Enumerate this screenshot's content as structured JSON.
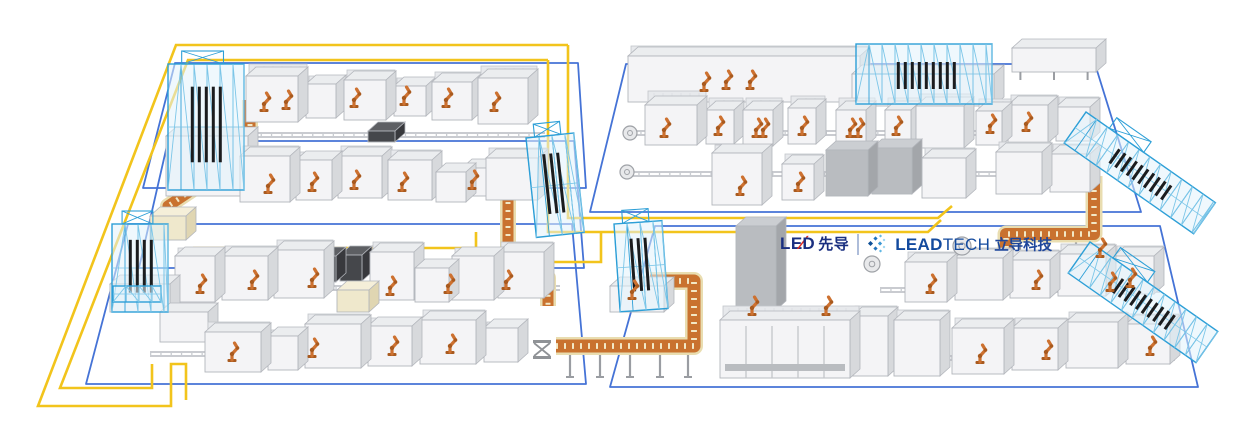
{
  "canvas": {
    "w": 1235,
    "h": 441,
    "bg": "#ffffff"
  },
  "logo": {
    "lead_prefix": "LE",
    "lead_slash": "∕",
    "lead_suffix": "D",
    "lead_cn": "先导",
    "brand_bold": "LEAD",
    "brand_light": "TECH",
    "brand_cn": "立导科技",
    "colors": {
      "navy": "#1a2f80",
      "red": "#e02b20",
      "brand_blue": "#134a9e",
      "separator": "#aebdda"
    },
    "icon_colors": [
      "#0d4f97",
      "#2173bc",
      "#3b97d3",
      "#62b8e4",
      "#8ed0ef"
    ],
    "icon_diamonds": [
      {
        "x": 3.5,
        "y": 9.5,
        "s": 3.6,
        "c": 0
      },
      {
        "x": 8.5,
        "y": 4.5,
        "s": 3.0,
        "c": 1
      },
      {
        "x": 8.5,
        "y": 14.5,
        "s": 3.0,
        "c": 1
      },
      {
        "x": 13.0,
        "y": 9.5,
        "s": 3.0,
        "c": 2
      },
      {
        "x": 13.5,
        "y": 2.0,
        "s": 2.2,
        "c": 3
      },
      {
        "x": 13.5,
        "y": 17.0,
        "s": 2.2,
        "c": 3
      },
      {
        "x": 17.0,
        "y": 6.0,
        "s": 1.9,
        "c": 4
      },
      {
        "x": 17.0,
        "y": 13.0,
        "s": 1.9,
        "c": 4
      }
    ]
  },
  "palette": {
    "zone_blue": "#4573d6",
    "agv_yellow": "#f2c41c",
    "rail": "#b7bac0",
    "rail_tick": "#c9ccd1",
    "conv_tan": "#e9ddb0",
    "conv_orange": "#c9722f",
    "conv_rung": "#f2e8c6",
    "machine_front": "#f4f4f6",
    "machine_top": "#ebedef",
    "machine_side": "#d7d9dc",
    "machine_stroke": "#b3b6bc",
    "backwall": "#e7e9ec",
    "backwall_stroke": "#c2c5ca",
    "dark_front": "#45474b",
    "dark_top": "#5d5f63",
    "dark_side": "#38393d",
    "med_front": "#b9bcc0",
    "med_top": "#cbced2",
    "med_side": "#a3a6aa",
    "blue_equip": "#cfe2f2",
    "tan_front": "#efe8cc",
    "tan_top": "#f5efd9",
    "tan_side": "#e0d6b2",
    "truss_blue": "#2d9fd7",
    "truss_light": "#7cc6e8",
    "truss_fill": "rgba(226,243,252,0.55)",
    "slat": "#1b1c1e",
    "robot": "#cd7130",
    "robot_dark": "#a85a1f",
    "lift_gray": "#8f9296"
  },
  "floor_zones": [
    {
      "name": "left-top",
      "points": "175,63 578,63 586,188 143,188"
    },
    {
      "name": "left-middle",
      "points": "168,141 574,141 584,268 139,268"
    },
    {
      "name": "left-bottom",
      "points": "128,224 572,224 586,384 86,384"
    },
    {
      "name": "right-top",
      "points": "626,64 1095,64 1141,212 590,212"
    },
    {
      "name": "right-bottom",
      "points": "655,226 1160,226 1198,387 610,387"
    }
  ],
  "agv_paths": [
    {
      "name": "outer-loop",
      "d": "M568,45 H176 L38,406 H171 V364 H186 V400"
    },
    {
      "name": "inner-loop",
      "d": "M548,60 H188 L60,388 H152 V364"
    },
    {
      "name": "cross-outer",
      "d": "M568,45 V218 H938 L952,206"
    },
    {
      "name": "cross-inner",
      "d": "M548,60 V232 H928 L941,220"
    },
    {
      "name": "branch-a",
      "d": "M476,232 V248 H193"
    },
    {
      "name": "branch-b",
      "d": "M601,232 V262 H193"
    }
  ],
  "rails": [
    {
      "y": 133,
      "x1": 240,
      "x2": 545
    },
    {
      "y": 189,
      "x1": 230,
      "x2": 545
    },
    {
      "y": 286,
      "x1": 150,
      "x2": 560
    },
    {
      "y": 352,
      "x1": 150,
      "x2": 520
    },
    {
      "y": 131,
      "x1": 630,
      "x2": 1090
    },
    {
      "y": 172,
      "x1": 628,
      "x2": 1085
    },
    {
      "y": 288,
      "x1": 880,
      "x2": 1160
    },
    {
      "y": 356,
      "x1": 910,
      "x2": 1175
    }
  ],
  "conveyors": [
    {
      "name": "spiral-left",
      "d": "M250,100 V130 L210,160 V178 L168,206 V234",
      "w": 11
    },
    {
      "name": "center-stair",
      "d": "M486,170 L508,196 V246 L548,278 V306",
      "w": 11
    },
    {
      "name": "bottom-bridge",
      "d": "M556,346 H694 V281 H650",
      "w": 13
    },
    {
      "name": "right-bridge",
      "d": "M1006,264 V234 H1094 V176",
      "w": 12
    }
  ],
  "bridge_legs": [
    [
      570,
      353,
      377
    ],
    [
      600,
      353,
      377
    ],
    [
      630,
      353,
      377
    ],
    [
      660,
      353,
      377
    ],
    [
      688,
      353,
      377
    ],
    [
      1020,
      240,
      262
    ],
    [
      1048,
      238,
      260
    ],
    [
      1076,
      236,
      258
    ]
  ],
  "machines": [
    [
      166,
      196,
      82,
      60,
      0,
      0
    ],
    [
      246,
      122,
      52,
      46,
      12,
      0
    ],
    [
      306,
      118,
      30,
      34,
      8,
      0
    ],
    [
      344,
      120,
      42,
      40,
      10,
      0
    ],
    [
      394,
      116,
      32,
      30,
      8,
      0
    ],
    [
      432,
      120,
      40,
      38,
      10,
      0
    ],
    [
      478,
      124,
      50,
      46,
      12,
      0
    ],
    [
      368,
      142,
      27,
      11,
      0,
      1
    ],
    [
      150,
      240,
      36,
      24,
      0,
      5
    ],
    [
      240,
      202,
      50,
      46,
      10,
      0
    ],
    [
      296,
      200,
      36,
      40,
      8,
      0
    ],
    [
      338,
      198,
      44,
      42,
      10,
      0
    ],
    [
      388,
      200,
      44,
      40,
      10,
      0
    ],
    [
      436,
      202,
      30,
      30,
      0,
      0
    ],
    [
      462,
      196,
      26,
      28,
      0,
      0
    ],
    [
      486,
      200,
      52,
      42,
      10,
      0
    ],
    [
      314,
      282,
      22,
      26,
      0,
      1
    ],
    [
      340,
      281,
      22,
      26,
      0,
      1
    ],
    [
      110,
      312,
      60,
      28,
      0,
      0
    ],
    [
      175,
      302,
      40,
      46,
      8,
      0
    ],
    [
      222,
      300,
      46,
      44,
      10,
      0
    ],
    [
      274,
      298,
      50,
      48,
      10,
      0
    ],
    [
      337,
      312,
      32,
      22,
      0,
      5
    ],
    [
      370,
      300,
      44,
      48,
      10,
      0
    ],
    [
      415,
      302,
      34,
      34,
      0,
      0
    ],
    [
      452,
      300,
      42,
      44,
      8,
      0
    ],
    [
      498,
      298,
      46,
      46,
      10,
      0
    ],
    [
      160,
      342,
      48,
      30,
      6,
      0
    ],
    [
      205,
      372,
      56,
      40,
      10,
      0
    ],
    [
      268,
      370,
      30,
      34,
      6,
      0
    ],
    [
      305,
      368,
      56,
      44,
      10,
      0
    ],
    [
      368,
      366,
      44,
      40,
      8,
      0
    ],
    [
      420,
      364,
      56,
      44,
      10,
      0
    ],
    [
      484,
      362,
      34,
      34,
      6,
      0
    ],
    [
      628,
      102,
      232,
      46,
      10,
      0
    ],
    [
      644,
      96,
      18,
      20,
      0,
      6
    ],
    [
      666,
      94,
      16,
      18,
      0,
      6
    ],
    [
      852,
      106,
      142,
      32,
      0,
      0
    ],
    [
      1012,
      72,
      84,
      24,
      0,
      4
    ],
    [
      645,
      145,
      52,
      40,
      14,
      0
    ],
    [
      706,
      144,
      28,
      34,
      12,
      0
    ],
    [
      743,
      146,
      30,
      36,
      12,
      0
    ],
    [
      788,
      144,
      28,
      36,
      12,
      0
    ],
    [
      836,
      146,
      30,
      36,
      12,
      0
    ],
    [
      885,
      144,
      26,
      34,
      12,
      0
    ],
    [
      916,
      148,
      48,
      42,
      12,
      0
    ],
    [
      976,
      145,
      26,
      34,
      12,
      0
    ],
    [
      1008,
      143,
      40,
      38,
      10,
      0
    ],
    [
      1056,
      141,
      34,
      34,
      10,
      0
    ],
    [
      712,
      205,
      50,
      52,
      8,
      0
    ],
    [
      782,
      200,
      32,
      36,
      10,
      0
    ],
    [
      826,
      196,
      42,
      46,
      0,
      3
    ],
    [
      872,
      194,
      40,
      46,
      0,
      3
    ],
    [
      922,
      198,
      44,
      40,
      10,
      0
    ],
    [
      996,
      194,
      46,
      42,
      10,
      0
    ],
    [
      1050,
      192,
      40,
      38,
      10,
      0
    ],
    [
      610,
      312,
      54,
      26,
      0,
      0
    ],
    [
      736,
      310,
      40,
      84,
      0,
      3
    ],
    [
      905,
      302,
      42,
      40,
      10,
      0
    ],
    [
      955,
      300,
      48,
      42,
      10,
      0
    ],
    [
      1010,
      298,
      40,
      38,
      10,
      0
    ],
    [
      1058,
      296,
      48,
      42,
      10,
      0
    ],
    [
      1114,
      294,
      40,
      38,
      10,
      0
    ],
    [
      720,
      378,
      130,
      58,
      14,
      2
    ],
    [
      845,
      368,
      16,
      13,
      0,
      1
    ],
    [
      852,
      376,
      36,
      60,
      10,
      0
    ],
    [
      894,
      376,
      46,
      56,
      10,
      0
    ],
    [
      952,
      374,
      52,
      46,
      10,
      0
    ],
    [
      1012,
      370,
      46,
      42,
      10,
      0
    ],
    [
      1066,
      368,
      52,
      46,
      10,
      0
    ],
    [
      1126,
      364,
      44,
      40,
      10,
      0
    ]
  ],
  "trusses": [
    {
      "x": 168,
      "y": 64,
      "w": 76,
      "h": 126,
      "dark": 1,
      "topper": 1,
      "rot": 0
    },
    {
      "x": 112,
      "y": 224,
      "w": 56,
      "h": 88,
      "dark": 1,
      "topper": 1,
      "rot": 0
    },
    {
      "x": 526,
      "y": 138,
      "w": 48,
      "h": 100,
      "dark": 1,
      "topper": 1,
      "rot": -6
    },
    {
      "x": 614,
      "y": 224,
      "w": 48,
      "h": 88,
      "dark": 1,
      "topper": 1,
      "rot": -4
    },
    {
      "x": 856,
      "y": 44,
      "w": 136,
      "h": 60,
      "dark": 1,
      "topper": 0,
      "rot": 0
    },
    {
      "x": 1086,
      "y": 112,
      "w": 158,
      "h": 38,
      "dark": 1,
      "topper": 1,
      "rot": 35
    },
    {
      "x": 1090,
      "y": 242,
      "w": 156,
      "h": 38,
      "dark": 1,
      "topper": 1,
      "rot": 35
    },
    {
      "x": 113,
      "y": 286,
      "w": 48,
      "h": 16,
      "dark": 0,
      "topper": 0,
      "rot": 0
    }
  ],
  "robots": [
    [
      264,
      112
    ],
    [
      286,
      110
    ],
    [
      354,
      108
    ],
    [
      404,
      106
    ],
    [
      446,
      108
    ],
    [
      494,
      112
    ],
    [
      268,
      194
    ],
    [
      312,
      192
    ],
    [
      354,
      190
    ],
    [
      402,
      192
    ],
    [
      472,
      190
    ],
    [
      200,
      294
    ],
    [
      252,
      290
    ],
    [
      312,
      288
    ],
    [
      390,
      296
    ],
    [
      448,
      294
    ],
    [
      506,
      290
    ],
    [
      232,
      362
    ],
    [
      312,
      358
    ],
    [
      392,
      356
    ],
    [
      450,
      354
    ],
    [
      704,
      92
    ],
    [
      726,
      90
    ],
    [
      750,
      90
    ],
    [
      664,
      138
    ],
    [
      718,
      136
    ],
    [
      756,
      138
    ],
    [
      763,
      138
    ],
    [
      802,
      136
    ],
    [
      850,
      138
    ],
    [
      858,
      138
    ],
    [
      896,
      136
    ],
    [
      990,
      134
    ],
    [
      1026,
      132
    ],
    [
      740,
      196
    ],
    [
      798,
      192
    ],
    [
      752,
      316
    ],
    [
      826,
      316
    ],
    [
      632,
      300
    ],
    [
      930,
      294
    ],
    [
      1036,
      290
    ],
    [
      1130,
      288
    ],
    [
      980,
      364
    ],
    [
      1046,
      360
    ],
    [
      1150,
      356
    ],
    [
      1100,
      258
    ],
    [
      1110,
      292
    ]
  ],
  "turntables": [
    [
      630,
      133,
      7
    ],
    [
      627,
      172,
      7
    ],
    [
      872,
      264,
      8
    ],
    [
      962,
      246,
      9
    ]
  ],
  "lifts": [
    [
      542,
      356
    ]
  ]
}
